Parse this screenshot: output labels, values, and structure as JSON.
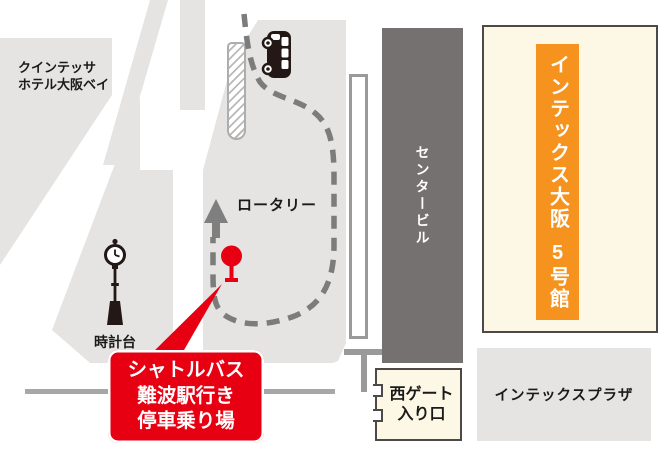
{
  "colors": {
    "red": "#e60012",
    "orange": "#f6921e",
    "cream": "#fcf8e5",
    "dark_border": "#4c4946",
    "block_gray": "#e5e4e3",
    "building_gray": "#767171",
    "path_gray": "#7c7c7c",
    "ink": "#231815"
  },
  "hotel": {
    "line1": "クインテッサ",
    "line2": "ホテル大阪ベイ"
  },
  "rotary": {
    "label": "ロータリー"
  },
  "clock_tower": {
    "label": "時計台"
  },
  "center_building": {
    "label": "センタービル"
  },
  "hall5": {
    "line1": "インテックス大阪",
    "line2": "5号館"
  },
  "west_gate": {
    "line1": "西ゲート",
    "line2": "入り口"
  },
  "plaza": {
    "label": "インテックスプラザ"
  },
  "callout": {
    "line1": "シャトルバス",
    "line2": "難波駅行き",
    "line3": "停車乗り場"
  },
  "icons": {
    "bus": "bus-icon",
    "clock_tower": "clock-tower-icon",
    "bus_stop": "bus-stop-pin-icon",
    "direction_arrow": "up-arrow-icon"
  }
}
